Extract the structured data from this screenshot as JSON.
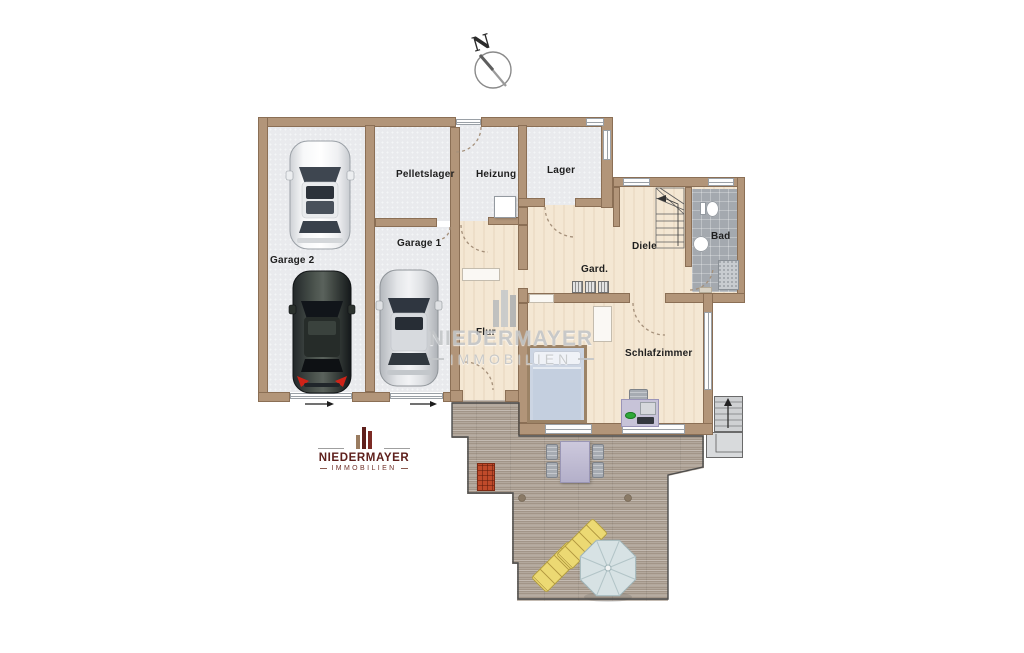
{
  "compass": {
    "label": "N"
  },
  "rooms": {
    "garage2": "Garage 2",
    "garage1": "Garage 1",
    "pelletslager": "Pelletslager",
    "heizung": "Heizung",
    "lager": "Lager",
    "diele": "Diele",
    "bad": "Bad",
    "gard": "Gard.",
    "flur": "Flur",
    "schlafzimmer": "Schlafzimmer"
  },
  "watermark": {
    "name": "NIEDERMAYER",
    "subtitle": "IMMOBILIEN"
  },
  "logo": {
    "name": "NIEDERMAYER",
    "subtitle": "IMMOBILIEN"
  },
  "colors": {
    "wall": "#b29579",
    "wallEdge": "#8b6f55",
    "floorGarage": "#e9eaed",
    "floorWood": "#f4e7d3",
    "floorTile": "#a4a9af",
    "terrace": "#b3a89c",
    "deckEdge": "#4c4c4c",
    "lounger": "#ecd973",
    "umbrella": "#d7e2e4",
    "doormat": "#bf4a2a",
    "logoRed": "#5f201c",
    "watermark": "#c3c6c8",
    "bedFrame": "#9c8366",
    "bedding": "#ccd5e3",
    "furniturePurple": "#c7c3d8"
  }
}
